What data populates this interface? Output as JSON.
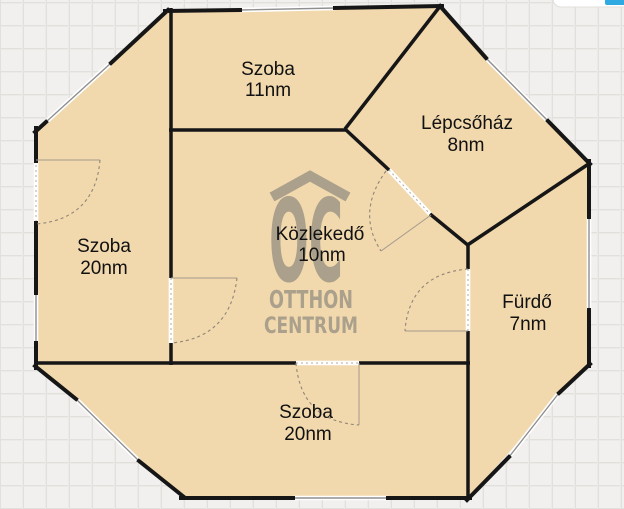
{
  "watermark": {
    "monogram": "OC",
    "roof_icon": "roof-chevron",
    "line1": "OTTHON",
    "line2": "CENTRUM",
    "color": "#a59c89"
  },
  "rooms": [
    {
      "id": "szoba-top",
      "name": "Szoba",
      "area": "11nm"
    },
    {
      "id": "lepcsohaz",
      "name": "Lépcsőház",
      "area": "8nm"
    },
    {
      "id": "szoba-left",
      "name": "Szoba",
      "area": "20nm"
    },
    {
      "id": "kozlekedo",
      "name": "Közlekedő",
      "area": "10nm"
    },
    {
      "id": "furdo",
      "name": "Fürdő",
      "area": "7nm"
    },
    {
      "id": "szoba-bottom",
      "name": "Szoba",
      "area": "20nm"
    }
  ],
  "colors": {
    "floor": "#f1d8ad",
    "wall": "#161616",
    "bg": "#f1f0ee",
    "grid": "#e2e0dd",
    "watermark": "#a59c89",
    "window-line": "#8f8f8f",
    "door-arc": "#8f8678",
    "accent": "#2fa9e1"
  }
}
